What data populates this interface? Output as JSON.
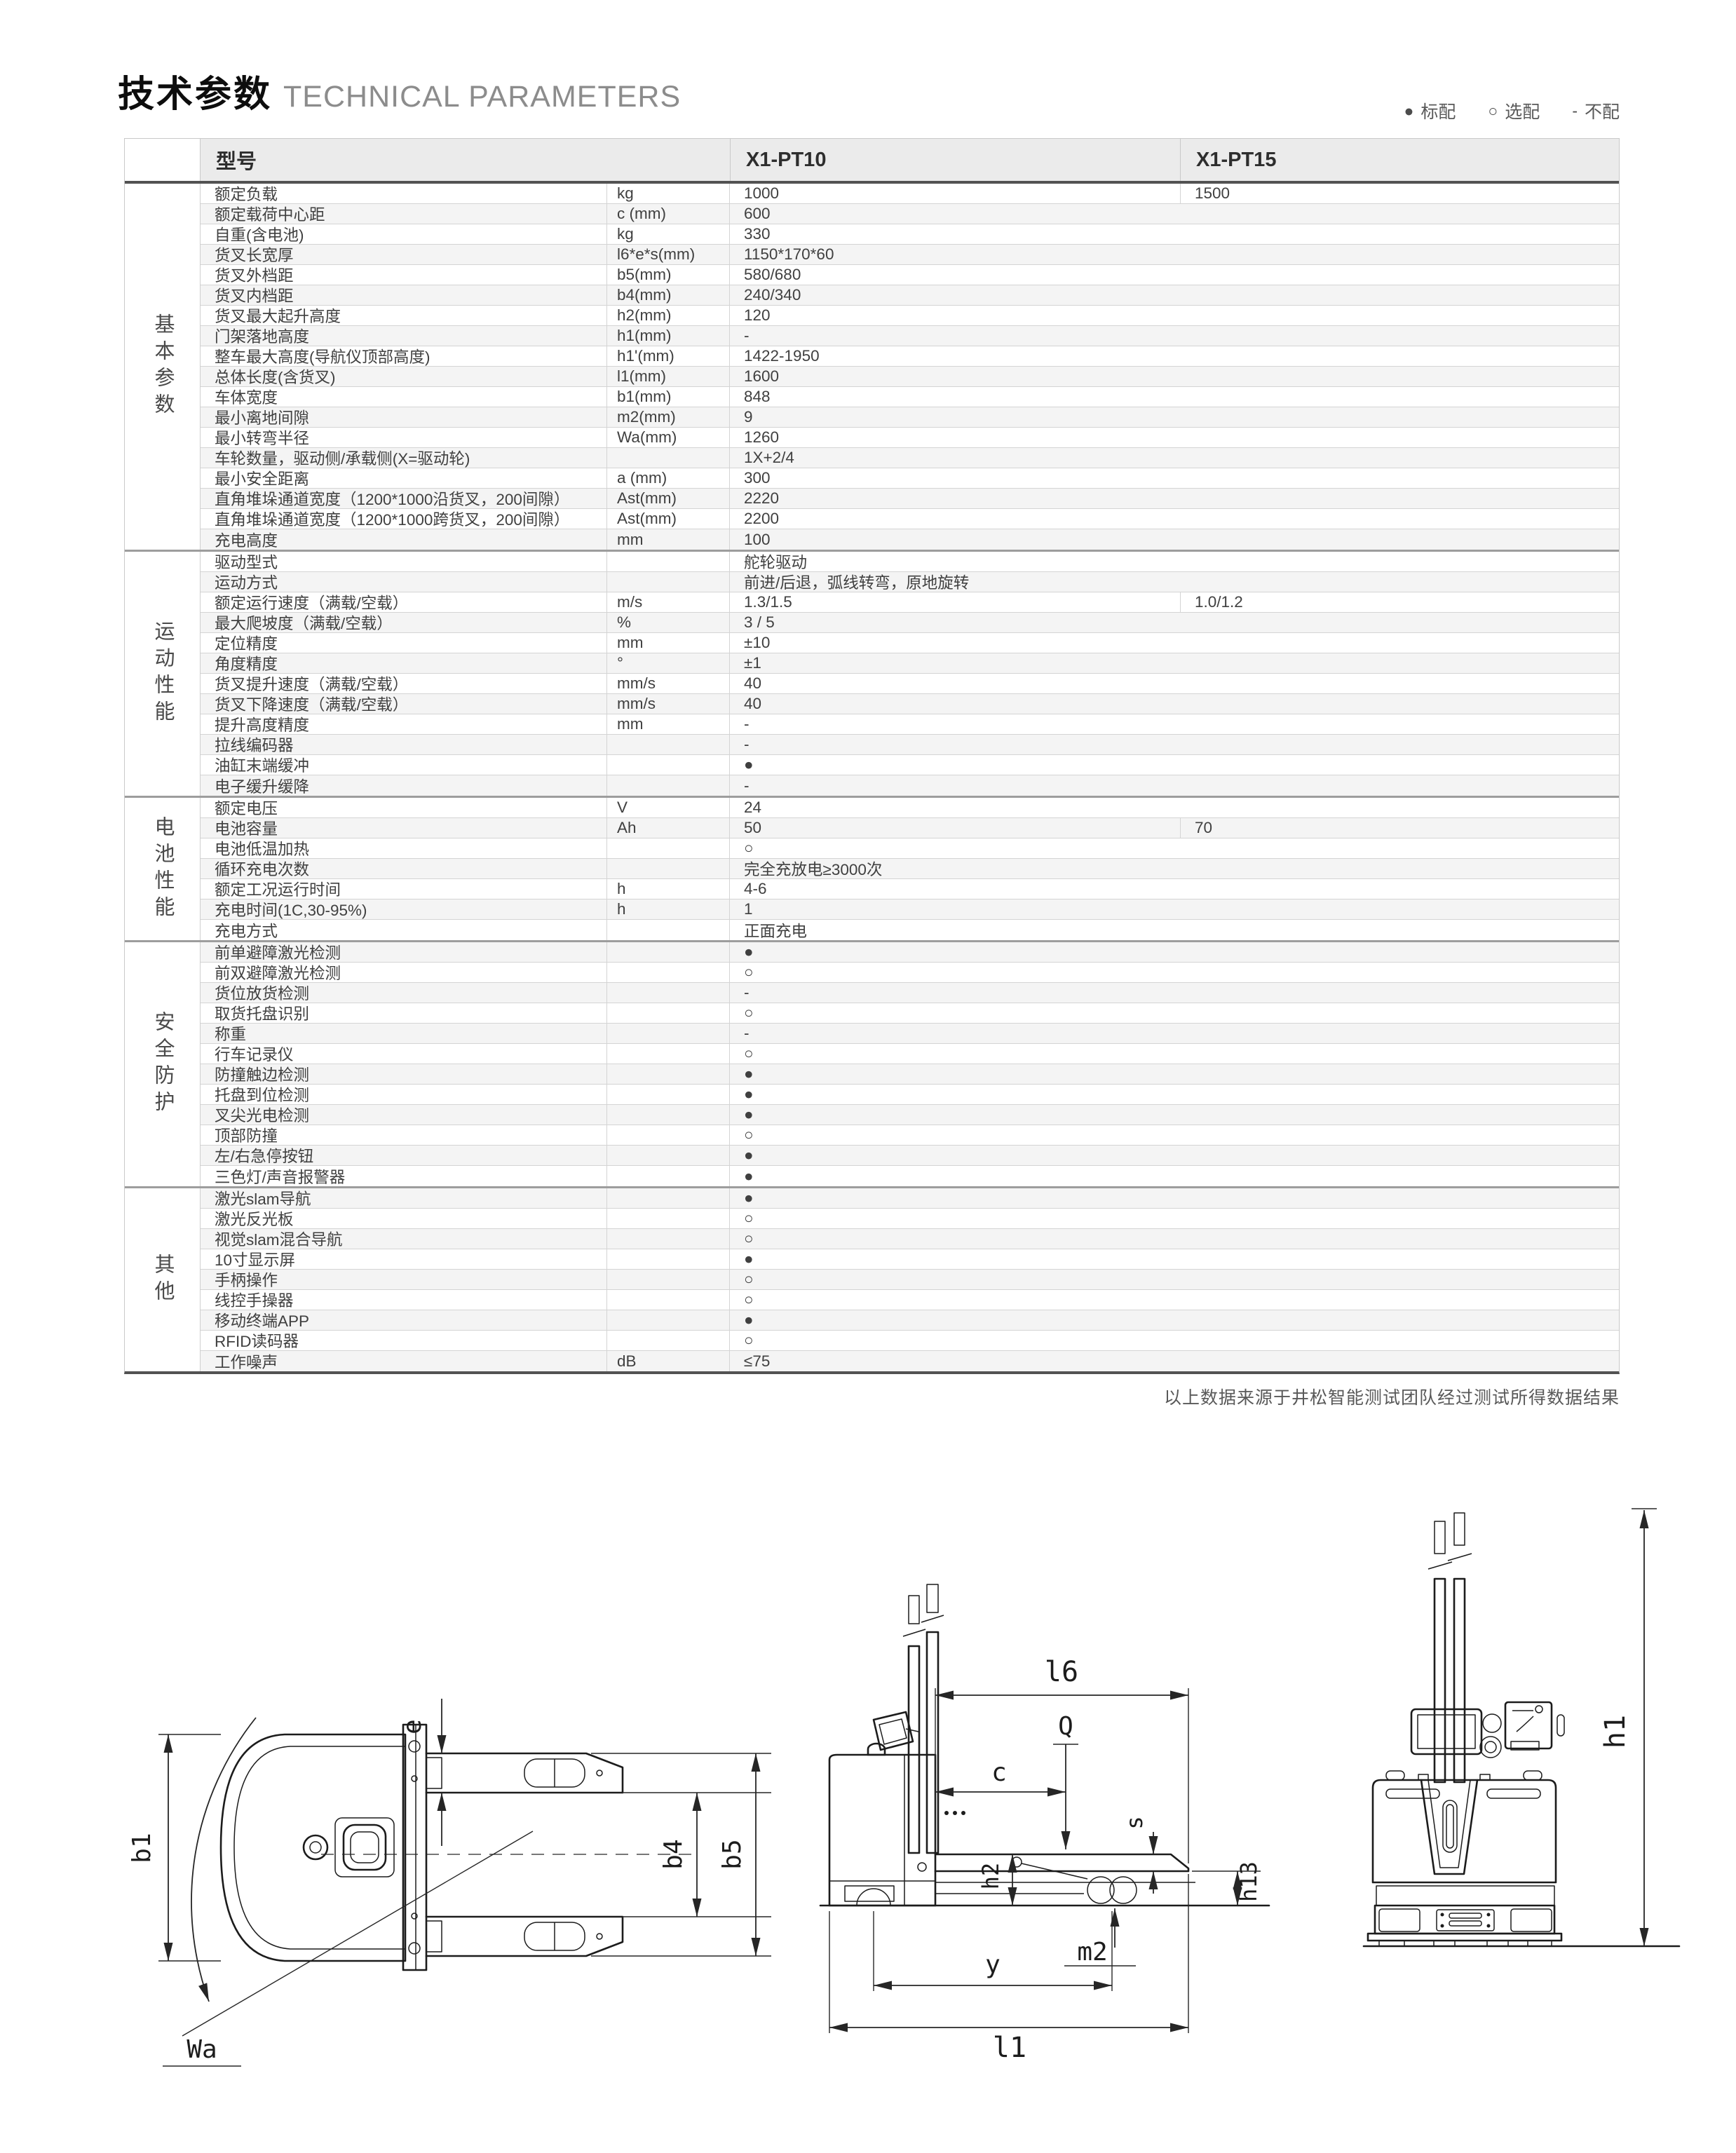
{
  "header": {
    "title_zh": "技术参数",
    "title_en": "TECHNICAL PARAMETERS",
    "legend": [
      {
        "symbol": "●",
        "label": "标配"
      },
      {
        "symbol": "○",
        "label": "选配"
      },
      {
        "symbol": "-",
        "label": "不配"
      }
    ]
  },
  "table": {
    "model_header": "型号",
    "models": [
      "X1-PT10",
      "X1-PT15"
    ],
    "sections": [
      {
        "name": "基本参数",
        "rows": [
          {
            "label": "额定负载",
            "unit": "kg",
            "v10": "1000",
            "v15": "1500"
          },
          {
            "label": "额定载荷中心距",
            "unit": "c (mm)",
            "v10": "600"
          },
          {
            "label": "自重(含电池)",
            "unit": "kg",
            "v10": "330"
          },
          {
            "label": "货叉长宽厚",
            "unit": "l6*e*s(mm)",
            "v10": "1150*170*60"
          },
          {
            "label": "货叉外档距",
            "unit": "b5(mm)",
            "v10": "580/680"
          },
          {
            "label": "货叉内档距",
            "unit": "b4(mm)",
            "v10": "240/340"
          },
          {
            "label": "货叉最大起升高度",
            "unit": "h2(mm)",
            "v10": "120"
          },
          {
            "label": "门架落地高度",
            "unit": "h1(mm)",
            "v10": "-"
          },
          {
            "label": "整车最大高度(导航仪顶部高度)",
            "unit": "h1'(mm)",
            "v10": "1422-1950"
          },
          {
            "label": "总体长度(含货叉)",
            "unit": "l1(mm)",
            "v10": "1600"
          },
          {
            "label": "车体宽度",
            "unit": "b1(mm)",
            "v10": "848"
          },
          {
            "label": "最小离地间隙",
            "unit": "m2(mm)",
            "v10": "9"
          },
          {
            "label": "最小转弯半径",
            "unit": "Wa(mm)",
            "v10": "1260"
          },
          {
            "label": "车轮数量，驱动侧/承载侧(X=驱动轮)",
            "unit": "",
            "v10": "1X+2/4"
          },
          {
            "label": "最小安全距离",
            "unit": "a (mm)",
            "v10": "300"
          },
          {
            "label": "直角堆垛通道宽度（1200*1000沿货叉，200间隙）",
            "unit": "Ast(mm)",
            "v10": "2220"
          },
          {
            "label": "直角堆垛通道宽度（1200*1000跨货叉，200间隙）",
            "unit": "Ast(mm)",
            "v10": "2200"
          },
          {
            "label": "充电高度",
            "unit": "mm",
            "v10": "100"
          }
        ]
      },
      {
        "name": "运动性能",
        "rows": [
          {
            "label": "驱动型式",
            "unit": "",
            "v10": "舵轮驱动"
          },
          {
            "label": "运动方式",
            "unit": "",
            "v10": "前进/后退，弧线转弯，原地旋转"
          },
          {
            "label": "额定运行速度（满载/空载）",
            "unit": "m/s",
            "v10": "1.3/1.5",
            "v15": "1.0/1.2"
          },
          {
            "label": "最大爬坡度（满载/空载）",
            "unit": "%",
            "v10": "3 / 5"
          },
          {
            "label": "定位精度",
            "unit": "mm",
            "v10": "±10"
          },
          {
            "label": "角度精度",
            "unit": "°",
            "v10": "±1"
          },
          {
            "label": "货叉提升速度（满载/空载）",
            "unit": "mm/s",
            "v10": "40"
          },
          {
            "label": "货叉下降速度（满载/空载）",
            "unit": "mm/s",
            "v10": "40"
          },
          {
            "label": "提升高度精度",
            "unit": "mm",
            "v10": "-"
          },
          {
            "label": "拉线编码器",
            "unit": "",
            "v10": "-"
          },
          {
            "label": "油缸末端缓冲",
            "unit": "",
            "v10": "●"
          },
          {
            "label": "电子缓升缓降",
            "unit": "",
            "v10": "-"
          }
        ]
      },
      {
        "name": "电池性能",
        "rows": [
          {
            "label": "额定电压",
            "unit": "V",
            "v10": "24"
          },
          {
            "label": "电池容量",
            "unit": "Ah",
            "v10": "50",
            "v15": "70"
          },
          {
            "label": "电池低温加热",
            "unit": "",
            "v10": "○"
          },
          {
            "label": "循环充电次数",
            "unit": "",
            "v10": "完全充放电≥3000次"
          },
          {
            "label": "额定工况运行时间",
            "unit": "h",
            "v10": "4-6"
          },
          {
            "label": "充电时间(1C,30-95%)",
            "unit": "h",
            "v10": "1"
          },
          {
            "label": "充电方式",
            "unit": "",
            "v10": "正面充电"
          }
        ]
      },
      {
        "name": "安全防护",
        "rows": [
          {
            "label": "前单避障激光检测",
            "unit": "",
            "v10": "●"
          },
          {
            "label": "前双避障激光检测",
            "unit": "",
            "v10": "○"
          },
          {
            "label": "货位放货检测",
            "unit": "",
            "v10": "-"
          },
          {
            "label": "取货托盘识别",
            "unit": "",
            "v10": "○"
          },
          {
            "label": "称重",
            "unit": "",
            "v10": "-"
          },
          {
            "label": "行车记录仪",
            "unit": "",
            "v10": "○"
          },
          {
            "label": "防撞触边检测",
            "unit": "",
            "v10": "●"
          },
          {
            "label": "托盘到位检测",
            "unit": "",
            "v10": "●"
          },
          {
            "label": "叉尖光电检测",
            "unit": "",
            "v10": "●"
          },
          {
            "label": "顶部防撞",
            "unit": "",
            "v10": "○"
          },
          {
            "label": "左/右急停按钮",
            "unit": "",
            "v10": "●"
          },
          {
            "label": "三色灯/声音报警器",
            "unit": "",
            "v10": "●"
          }
        ]
      },
      {
        "name": "其他",
        "rows": [
          {
            "label": "激光slam导航",
            "unit": "",
            "v10": "●"
          },
          {
            "label": "激光反光板",
            "unit": "",
            "v10": "○"
          },
          {
            "label": "视觉slam混合导航",
            "unit": "",
            "v10": "○"
          },
          {
            "label": "10寸显示屏",
            "unit": "",
            "v10": "●"
          },
          {
            "label": "手柄操作",
            "unit": "",
            "v10": "○"
          },
          {
            "label": "线控手操器",
            "unit": "",
            "v10": "○"
          },
          {
            "label": "移动终端APP",
            "unit": "",
            "v10": "●"
          },
          {
            "label": "RFID读码器",
            "unit": "",
            "v10": "○"
          },
          {
            "label": "工作噪声",
            "unit": "dB",
            "v10": "≤75"
          }
        ]
      }
    ]
  },
  "footnote": "以上数据来源于井松智能测试团队经过测试所得数据结果",
  "colors": {
    "header_bg": "#ebebeb",
    "row_alt": "#f4f4f4",
    "rule_dark": "#525252",
    "rule_mid": "#9d9d9d",
    "text": "#404040"
  },
  "diagrams": {
    "top_view": {
      "labels": {
        "b1": "b1",
        "e": "e",
        "b4": "b4",
        "b5": "b5",
        "wa": "Wa"
      }
    },
    "side_view": {
      "labels": {
        "l6": "l6",
        "q": "Q",
        "c": "c",
        "h2": "h2",
        "s": "s",
        "h13": "h13",
        "m2": "m2",
        "y": "y",
        "l1": "l1"
      }
    },
    "front_view": {
      "labels": {
        "h1": "h1"
      }
    }
  }
}
